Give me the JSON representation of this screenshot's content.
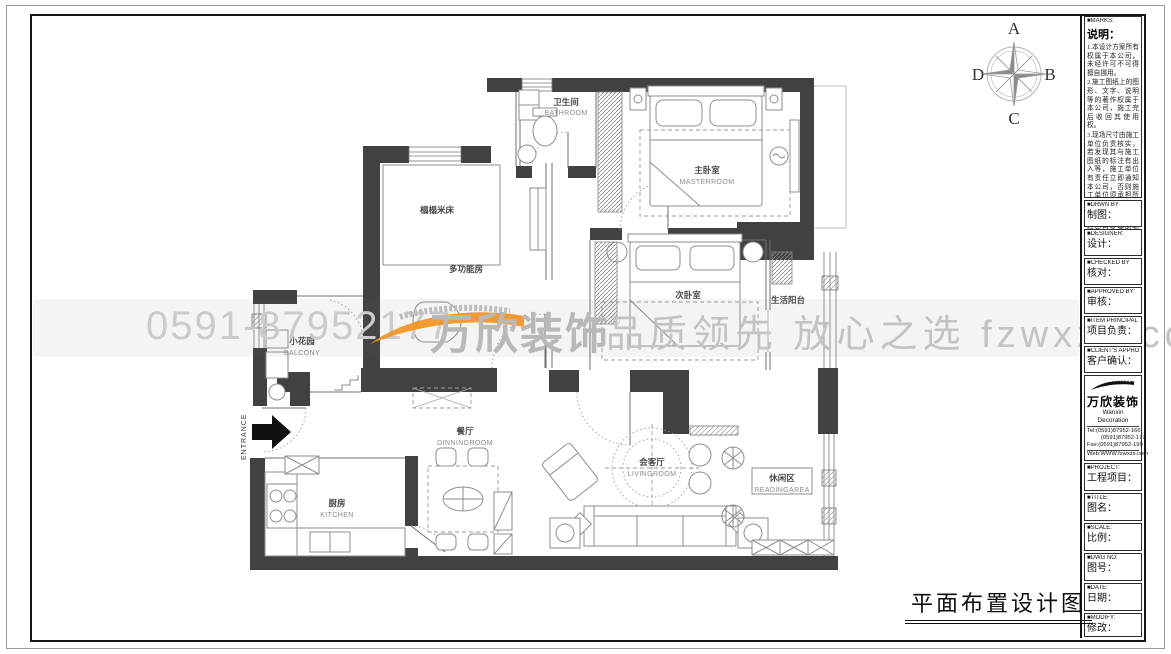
{
  "sheet": {
    "bottom_title": "平面布置设计图"
  },
  "compass": {
    "top": "A",
    "right": "B",
    "bottom": "C",
    "left": "D"
  },
  "colors": {
    "wall": "#414141",
    "brand_orange": "#f0931f",
    "watermark_gray": "#c6c6c6"
  },
  "watermark": {
    "phone": "0591-87952177",
    "brand": "万欣装饰",
    "reg": "®",
    "slogan": "品质领先 放心之选",
    "site": "fzwxzs.com"
  },
  "plan": {
    "entrance": "ENTRANCE",
    "rooms": {
      "bathroom": {
        "cn": "卫生间",
        "en": "BATHROOM"
      },
      "master": {
        "cn": "主卧室",
        "en": "MASTERROOM"
      },
      "tatami": {
        "cn": "榻榻米床"
      },
      "multi": {
        "cn": "多功能房"
      },
      "second": {
        "cn": "次卧室"
      },
      "life_balcony": {
        "cn": "生活阳台"
      },
      "garden": {
        "cn": "小花园",
        "en": "BALCONY"
      },
      "dining": {
        "cn": "餐厅",
        "en": "DINNINGROOM"
      },
      "living": {
        "cn": "会客厅",
        "en": "LIVINGROOM"
      },
      "reading": {
        "cn": "休闲区",
        "en": "READINGAREA"
      },
      "kitchen": {
        "cn": "厨房",
        "en": "KITCHEN"
      }
    }
  },
  "titleblock": {
    "marks": {
      "tag": "■MARKS:",
      "heading": "说明：",
      "note1": "1.本设计方案所有权属于本公司，未经许可不可得擅自挪用。",
      "note2": "2.施工图纸上的图形、文字、说明等的著作权属于本公司，施工完后收回其使用权。",
      "note3": "3.现场尺寸由施工单位负责核实，若发现其与施工图纸的标注有出入等，施工单位有责任立即通知本公司，否则施工单位须承担所有责任。",
      "note4": "4.本设计方案是按客户要求设计，经客户签字即视为同意认可，不得随意更改。"
    },
    "rows": [
      {
        "tag": "■DRWN BY",
        "label": "制图："
      },
      {
        "tag": "■DESIGNER:",
        "label": "设计："
      },
      {
        "tag": "■CHECKED BY",
        "label": "核对："
      },
      {
        "tag": "■APPROVED BY:",
        "label": "审核："
      },
      {
        "tag": "■ITEM PRINCIPAL BY:",
        "label": "项目负责："
      },
      {
        "tag": "■CLIENT'S APPROVAL:",
        "label": "客户确认："
      }
    ],
    "company": {
      "name_cn": "万欣装饰",
      "name_en": "Wanxin Decoration",
      "tel1": "Tel:(0591)87952-166",
      "tel2": "(0591)87952-177",
      "fax": "Fax:(0591)87952-199",
      "web": "Web:WWW.fzwxzs.com"
    },
    "rows2": [
      {
        "tag": "■PROJECT:",
        "label": "工程项目："
      },
      {
        "tag": "■TITLE:",
        "label": "图名："
      },
      {
        "tag": "■SCALE:",
        "label": "比例："
      },
      {
        "tag": "■DWG NO:",
        "label": "图号："
      },
      {
        "tag": "■DATE:",
        "label": "日期："
      },
      {
        "tag": "■MODIFY:",
        "label": "修改："
      }
    ]
  }
}
